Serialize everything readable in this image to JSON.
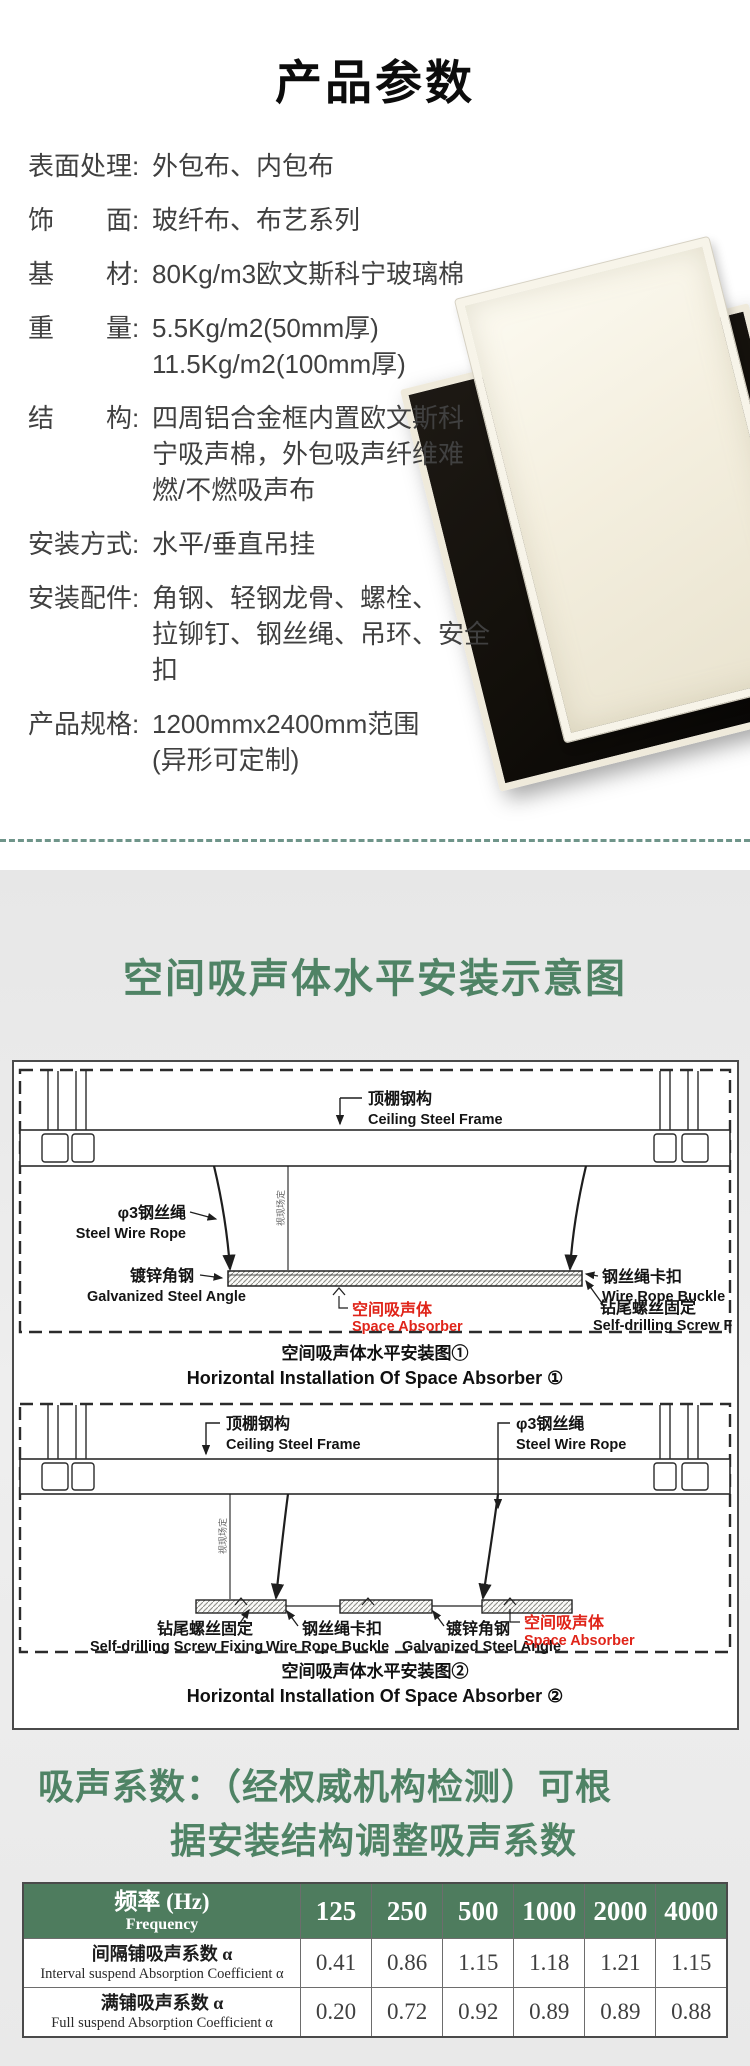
{
  "product_params": {
    "title": "产品参数",
    "specs": [
      {
        "label": "表面处理:",
        "value": "外包布、内包布"
      },
      {
        "label": "饰　　面:",
        "value": "玻纤布、布艺系列"
      },
      {
        "label": "基　　材:",
        "value": "80Kg/m3欧文斯科宁玻璃棉"
      },
      {
        "label": "重　　量:",
        "value": "5.5Kg/m2(50mm厚)\n11.5Kg/m2(100mm厚)"
      },
      {
        "label": "结　　构:",
        "value": "四周铝合金框内置欧文斯科\n宁吸声棉，外包吸声纤维难\n燃/不燃吸声布"
      },
      {
        "label": "安装方式:",
        "value": "水平/垂直吊挂"
      },
      {
        "label": "安装配件:",
        "value": "角钢、轻钢龙骨、螺栓、\n拉铆钉、钢丝绳、吊环、安全扣"
      },
      {
        "label": "产品规格:",
        "value": "1200mmx2400mm范围\n(异形可定制)"
      }
    ]
  },
  "install_section": {
    "title": "空间吸声体水平安装示意图",
    "labels": {
      "ceiling_cn": "顶棚钢构",
      "ceiling_en": "Ceiling Steel Frame",
      "wire_cn": "φ3钢丝绳",
      "wire_en": "Steel Wire Rope",
      "angle_cn": "镀锌角钢",
      "angle_en": "Galvanized Steel Angle",
      "absorber_cn": "空间吸声体",
      "absorber_en": "Space Absorber",
      "buckle_cn": "钢丝绳卡扣",
      "buckle_en": "Wire Rope Buckle",
      "screw_cn": "钻尾螺丝固定",
      "screw_en": "Self-drilling Screw Fixing",
      "site_note": "视现场定"
    },
    "diagram1": {
      "caption_cn": "空间吸声体水平安装图①",
      "caption_en": "Horizontal Installation Of Space Absorber ①"
    },
    "diagram2": {
      "caption_cn": "空间吸声体水平安装图②",
      "caption_en": "Horizontal Installation Of Space Absorber ②"
    }
  },
  "coefficient_section": {
    "heading_line1": "吸声系数：（经权威机构检测）可根",
    "heading_line2": "据安装结构调整吸声系数",
    "table": {
      "header_cn": "频率 (Hz)",
      "header_en": "Frequency",
      "frequencies": [
        "125",
        "250",
        "500",
        "1000",
        "2000",
        "4000"
      ],
      "rows": [
        {
          "cn": "间隔铺吸声系数 α",
          "en": "Interval suspend Absorption Coefficient α",
          "values": [
            "0.41",
            "0.86",
            "1.15",
            "1.18",
            "1.21",
            "1.15"
          ]
        },
        {
          "cn": "满铺吸声系数 α",
          "en": "Full suspend Absorption Coefficient α",
          "values": [
            "0.20",
            "0.72",
            "0.92",
            "0.89",
            "0.89",
            "0.88"
          ]
        }
      ]
    }
  },
  "colors": {
    "accent_green": "#4f8365",
    "table_header_green": "#4e7c5e",
    "absorber_red": "#e02419",
    "divider_teal": "#6f958a"
  }
}
